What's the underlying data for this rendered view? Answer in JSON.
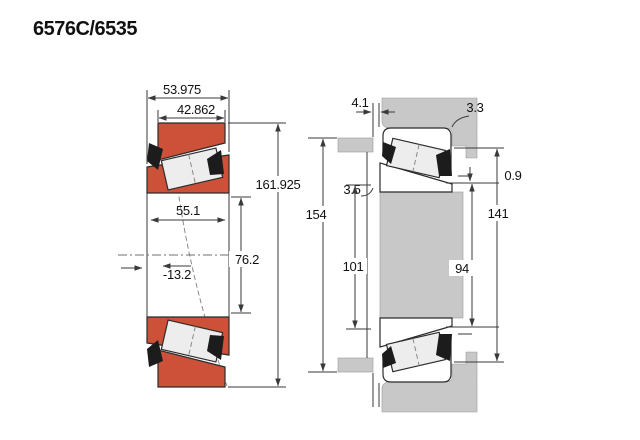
{
  "title": "6576C/6535",
  "colors": {
    "background": "#ffffff",
    "bearing-fill": "#cd5138",
    "metal-gray": "#c8c8c8",
    "roller-fill": "#ededed",
    "line": "#3a3a3a"
  },
  "left_view": {
    "dimensions": {
      "overall_width": "53.975",
      "cup_width": "42.862",
      "outer_diameter": "161.925",
      "cone_width": "55.1",
      "bore_diameter": "76.2",
      "load_center_offset": "-13.2"
    }
  },
  "right_view": {
    "dimensions": {
      "face_standout": "4.1",
      "housing_fillet_radius": "3.3",
      "shaft_fillet_radius": "3.5",
      "axial_gap": "0.9",
      "abutment_diameter": "154",
      "housing_shoulder_diameter": "141",
      "backing_diameter": "101",
      "shaft_shoulder_diameter": "94"
    }
  }
}
